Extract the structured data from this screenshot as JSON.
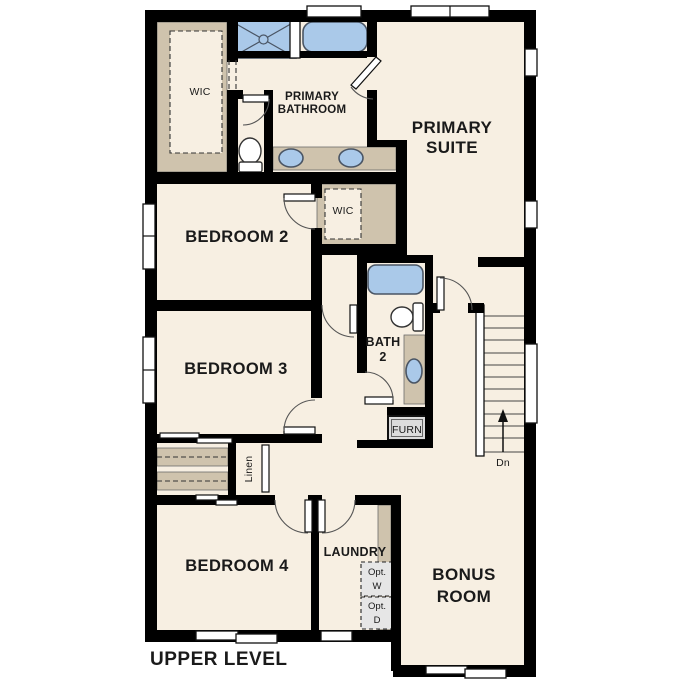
{
  "plan": {
    "title": "UPPER LEVEL",
    "level": "Upper Level floor plan"
  },
  "colors": {
    "floor": "#f7efe2",
    "cabinet_tan": "#cfc3ad",
    "fixture_blue": "#aac9e9",
    "wall_black": "#000000",
    "fixture_outline": "#4a5564"
  },
  "rooms": {
    "primary_suite": {
      "label_line1": "PRIMARY",
      "label_line2": "SUITE"
    },
    "primary_bathroom": {
      "label_line1": "PRIMARY",
      "label_line2": "BATHROOM"
    },
    "primary_wic": {
      "label": "WIC"
    },
    "bedroom2": {
      "label": "BEDROOM 2"
    },
    "bedroom2_wic": {
      "label": "WIC"
    },
    "bedroom3": {
      "label": "BEDROOM 3"
    },
    "bath2": {
      "label_line1": "BATH",
      "label_line2": "2"
    },
    "bedroom4": {
      "label": "BEDROOM 4"
    },
    "laundry": {
      "label": "LAUNDRY"
    },
    "bonus_room": {
      "label_line1": "BONUS",
      "label_line2": "ROOM"
    },
    "linen_closet": {
      "label": "Linen"
    },
    "furnace_closet": {
      "label": "FURN"
    }
  },
  "stairs": {
    "direction_label": "Dn"
  },
  "laundry_options": {
    "washer_line1": "Opt.",
    "washer_line2": "W",
    "dryer_line1": "Opt.",
    "dryer_line2": "D"
  }
}
